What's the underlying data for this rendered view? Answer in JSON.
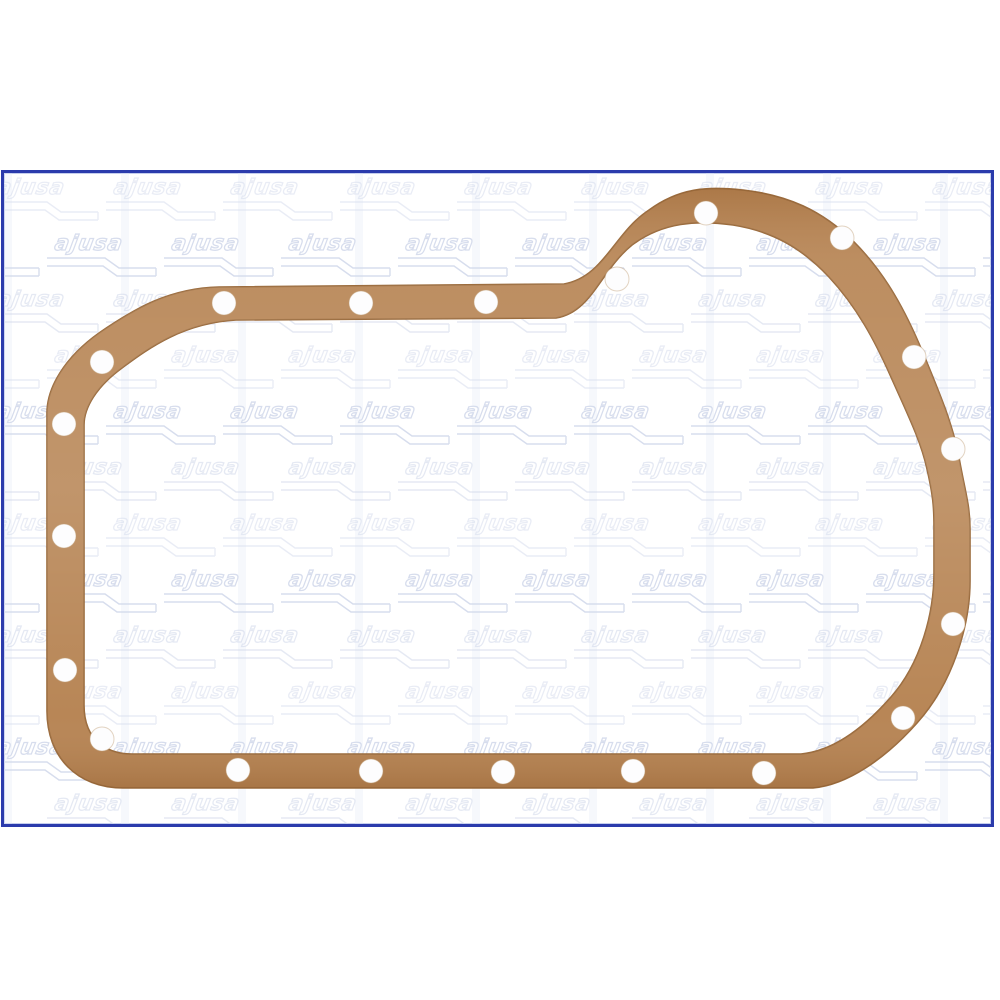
{
  "frame": {
    "border_color": "#2b3bac",
    "background": "#ffffff"
  },
  "watermark": {
    "text": "ajusa",
    "ink": "#d4dbec",
    "rows": 12,
    "cols": 10
  },
  "gasket": {
    "label": "oil-pan-gasket",
    "fill": "#b5814f",
    "edge": "#9a6a3b",
    "hole_fill": "#fdfdfe",
    "hole_rim": "#c2a077",
    "hole_radius": 12,
    "hole_count": 20,
    "holes": [
      [
        220,
        130
      ],
      [
        357,
        130
      ],
      [
        482,
        129
      ],
      [
        613,
        106
      ],
      [
        702,
        40
      ],
      [
        838,
        65
      ],
      [
        910,
        184
      ],
      [
        949,
        276
      ],
      [
        949,
        451
      ],
      [
        899,
        545
      ],
      [
        760,
        600
      ],
      [
        629,
        598
      ],
      [
        499,
        599
      ],
      [
        367,
        598
      ],
      [
        234,
        597
      ],
      [
        98,
        189
      ],
      [
        60,
        251
      ],
      [
        60,
        363
      ],
      [
        61,
        497
      ],
      [
        98,
        566
      ]
    ]
  }
}
